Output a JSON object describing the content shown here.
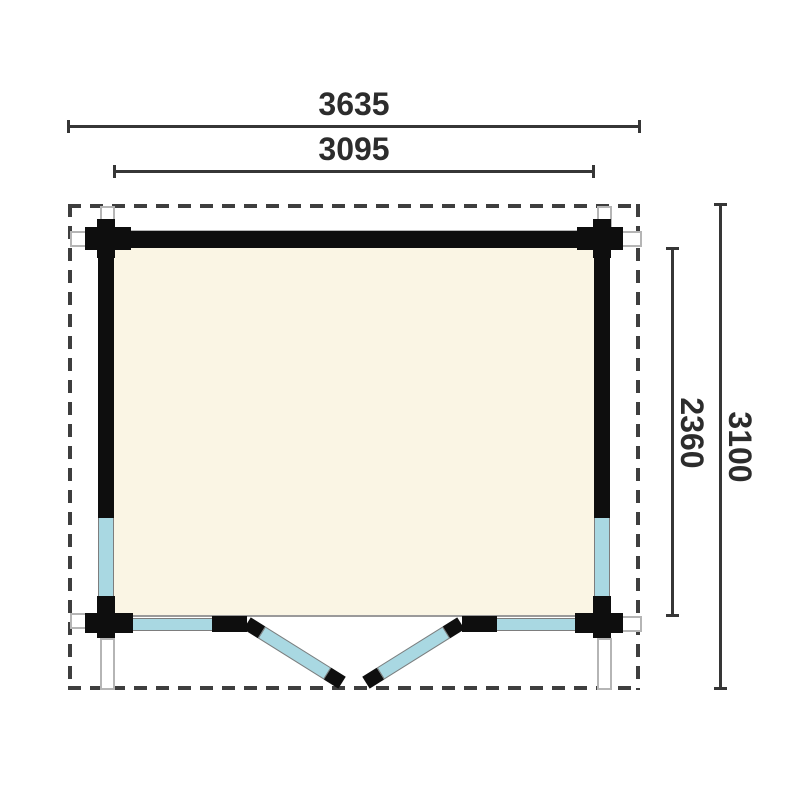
{
  "drawing": {
    "type": "log-cabin floor plan, top view",
    "dimensions": {
      "roof_width": "3635",
      "wall_width": "3095",
      "inner_depth": "2360",
      "roof_depth": "3100"
    },
    "colors": {
      "wall": "#0e0e0e",
      "floor": "#faf5e4",
      "glazing": "#a9d8e2",
      "dimension_line": "#363636",
      "roof_outline_dash": "#3e3e3e",
      "connector_border": "#b5b5b5"
    },
    "features": {
      "roof_overhang": "dashed rectangle",
      "windows": [
        "left wall lower window",
        "right wall lower window"
      ],
      "doors": "double outward-swinging glazed doors, bottom center",
      "corner_posts": 4
    }
  }
}
